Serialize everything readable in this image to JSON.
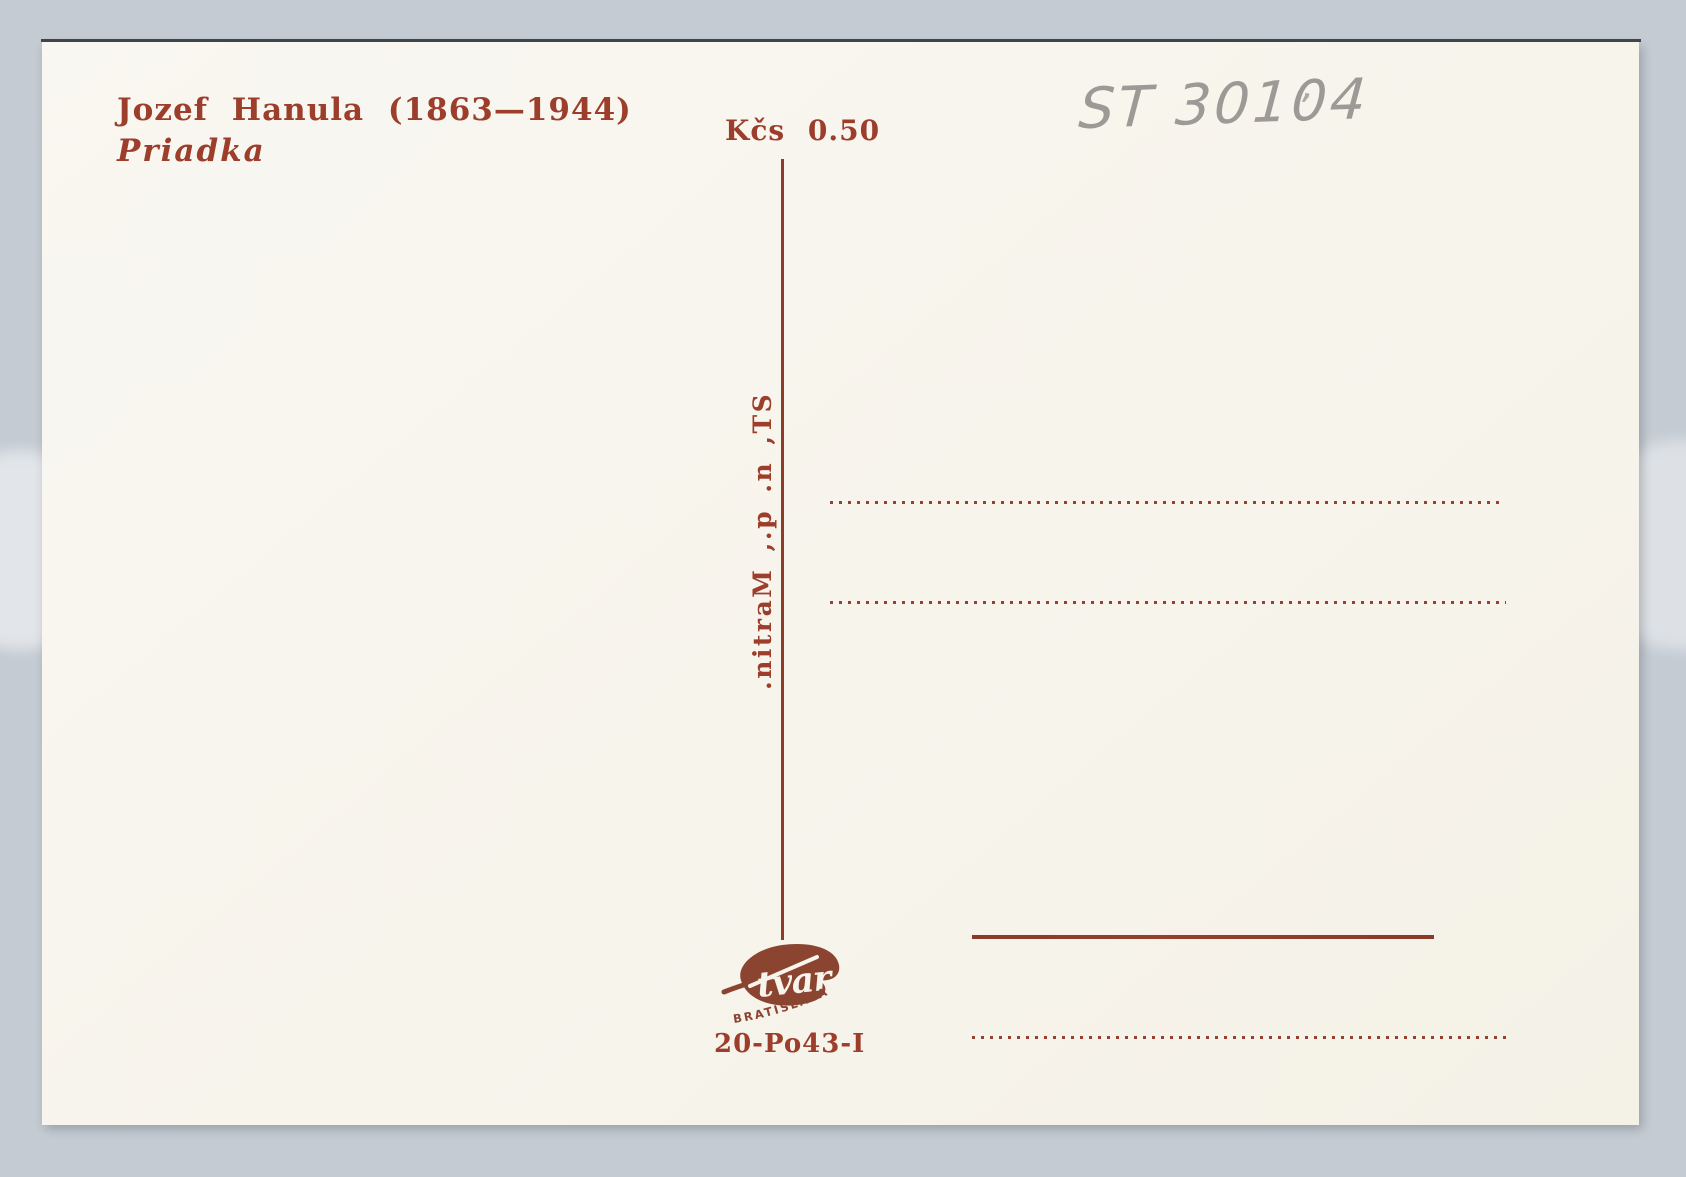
{
  "postcard": {
    "artist_line": "Jozef Hanula (1863—1944)",
    "artwork_title": "Priadka",
    "price_label": "Kčs 0.50",
    "publisher_line": "ST, n. p., Martin.",
    "handwritten_inventory": "ST 30104",
    "handwritten_tick": "’",
    "logo": {
      "script_name": "tvar",
      "city": "BRATISLAVA"
    },
    "print_code": "20-Po43-I",
    "colors": {
      "ink_red": "#9c3e2b",
      "line_red": "#8d3c28",
      "logo_brown": "#8a4430",
      "pencil_gray": "#8d8b88",
      "card_cream": "#f7f4ec",
      "backdrop_blue": "#c4cbd3"
    }
  }
}
